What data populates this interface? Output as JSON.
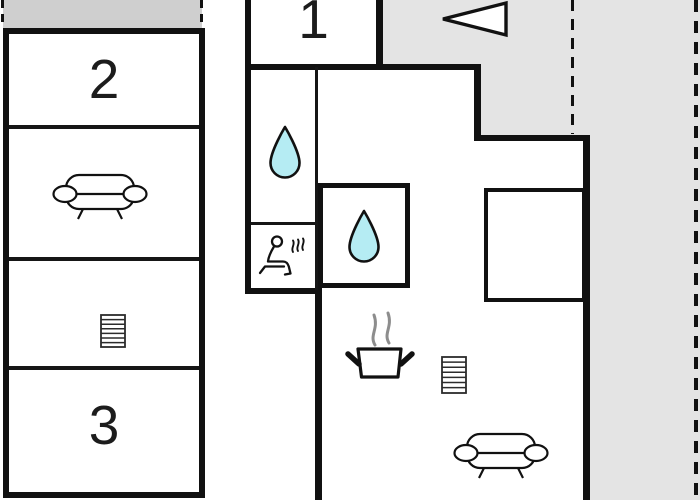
{
  "floor_plan": {
    "room_labels": [
      {
        "name": "room-1",
        "label": "1"
      },
      {
        "name": "room-2",
        "label": "2"
      },
      {
        "name": "room-3",
        "label": "3"
      }
    ],
    "icons": {
      "living_sofa_left": "sofa-icon",
      "living_sofa_right": "sofa-icon",
      "stairs_left": "stairs-icon",
      "stairs_right": "stairs-icon",
      "bathroom_drop": "water-drop-icon",
      "shower_drop": "water-drop-icon",
      "sauna": "sauna-icon",
      "kitchen_stove": "stove-steam-icon",
      "terrace_arrow": "direction-arrow-icon"
    },
    "colors": {
      "wall": "#111111",
      "terrace_gray": "#e4e4e4",
      "top_band_gray": "#cfcfcf",
      "water_drop": "#b5ecf3",
      "steam": "#8d8d8d",
      "background": "#ffffff"
    }
  }
}
